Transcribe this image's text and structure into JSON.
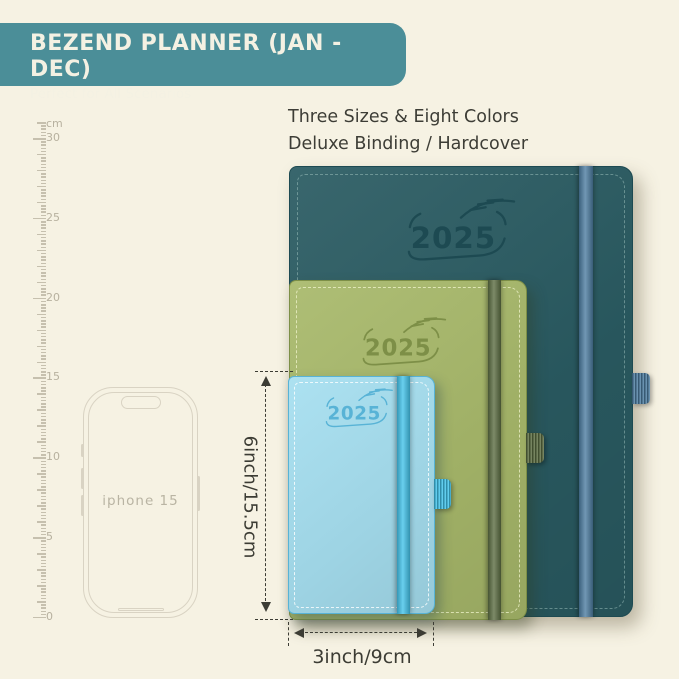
{
  "background_color": "#f6f2e3",
  "header": {
    "title": "BEZEND PLANNER (JAN - DEC)",
    "subtitle": "Perfect for All Scenarios",
    "bg_color": "#4b8e98",
    "text_color": "#f4f1e3"
  },
  "headline": {
    "line1": "Three Sizes & Eight Colors",
    "line2": "Deluxe Binding / Hardcover",
    "text_color": "#3d3d36"
  },
  "ruler": {
    "unit": "cm",
    "max_cm": 30,
    "min_cm": 0,
    "label_step_cm": 5,
    "tick_color": "#c6c0ae",
    "label_color": "#b7b19f"
  },
  "phone": {
    "label": "iphone 15",
    "outline_color": "#d9d3c3"
  },
  "planners": {
    "large": {
      "year": "2025",
      "cover_color": "#2a5b62",
      "emboss_color": "#1d4a52",
      "elastic_color": "#4d7da1",
      "stitch_color": "rgba(178,210,205,0.45)"
    },
    "medium": {
      "year": "2025",
      "cover_color": "#a8b96b",
      "emboss_color": "#7d8f47",
      "elastic_color": "#5c6d42",
      "stitch_color": "rgba(240,244,205,0.75)"
    },
    "small": {
      "year": "2025",
      "cover_color": "#a6dff0",
      "emboss_color": "#58b3d6",
      "elastic_color": "#43c3ea",
      "stitch_color": "rgba(255,255,255,0.80)"
    }
  },
  "dimensions": {
    "height_label": "6inch/15.5cm",
    "width_label": "3inch/9cm",
    "line_color": "#3c3c34"
  }
}
